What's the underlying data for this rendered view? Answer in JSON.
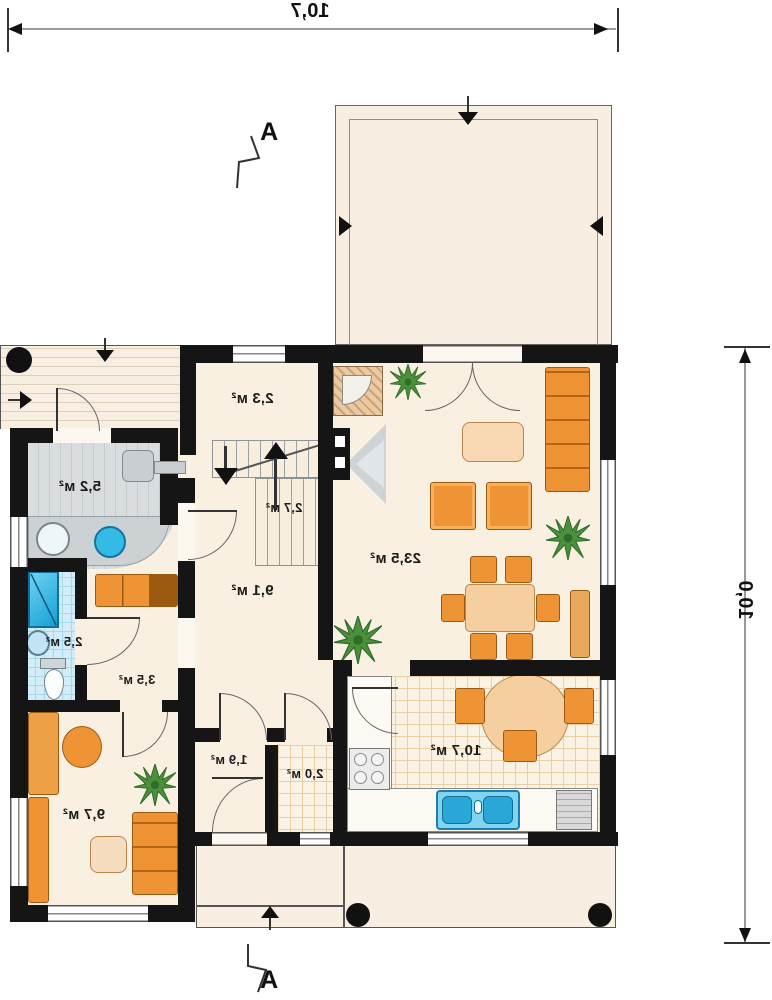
{
  "dimensions": {
    "width_label": "10,7",
    "height_label": "10,0"
  },
  "section": {
    "label": "A"
  },
  "rooms": {
    "vestibule": "5,2 м²",
    "wc_top": "2,3 м²",
    "stairs": "2,7 м²",
    "hall": "9,1 м²",
    "living": "23,5 м²",
    "bath": "2,5 м²",
    "corridor": "3,5 м²",
    "storage": "1,9 м²",
    "pantry": "2,0 м²",
    "kitchen": "10,7 м²",
    "bedroom": "9,7 м²"
  },
  "colors": {
    "wall": "#151515",
    "floor_cream": "#f9f0e1",
    "furniture_orange": "#ef9435",
    "table_tan": "#f6cfa0",
    "tile_blue": "#d2ecf8",
    "water_blue": "#2fb9e8",
    "plant_green": "#4e8f3c",
    "floor_gray": "#d9dde0",
    "dimension_gray": "#9a9a9a"
  }
}
